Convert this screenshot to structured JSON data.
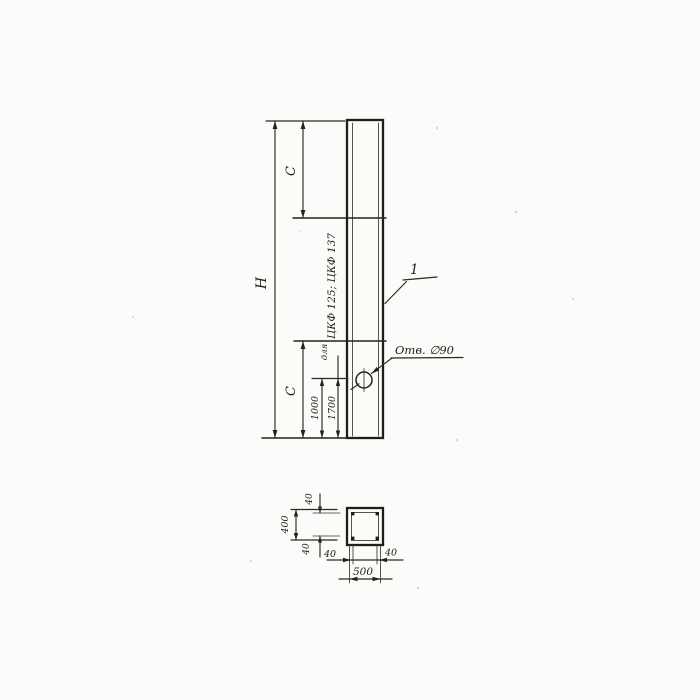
{
  "page": {
    "paper_color": "#fbfbf9",
    "ink_color": "#26231d"
  },
  "elevation": {
    "part_label": "1",
    "hole_label": "Отв. ∅90",
    "dims": {
      "height_total": "Н",
      "c_top": "С",
      "c_bottom": "С",
      "hole_offset": "1000",
      "second_offset": "1700"
    },
    "note": {
      "line1": "для",
      "line2": "ЦКФ 125; ЦКФ 137"
    }
  },
  "section": {
    "dims": {
      "width_total": "500",
      "height_total": "400",
      "cover_top": "40",
      "cover_bottom": "40",
      "cover_left": "40",
      "cover_right": "40"
    }
  }
}
